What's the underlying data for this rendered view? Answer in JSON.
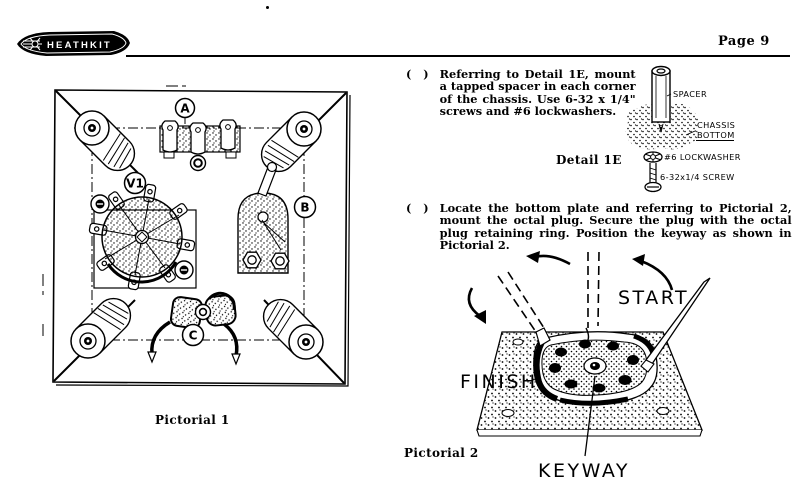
{
  "page": {
    "brand": "HEATHKIT",
    "page_number": "Page 9"
  },
  "instructions": [
    {
      "checkbox": "( )",
      "text": "Referring to Detail 1E, mount a tapped spacer in each corner of the chassis. Use 6-32 x 1/4\" screws and #6 lockwashers."
    },
    {
      "checkbox": "( )",
      "text": "Locate the bottom plate and referring to Pictorial 2, mount the octal plug. Secure the plug with the octal plug retaining ring. Position the keyway as shown in Pictorial 2."
    }
  ],
  "detail_1e": {
    "caption": "Detail 1E",
    "labels": {
      "spacer": "SPACER",
      "chassis_line1": "CHASSIS",
      "chassis_line2": "BOTTOM",
      "lockwasher": "#6 LOCKWASHER",
      "screw": "6-32x1/4 SCREW"
    }
  },
  "pictorial_1": {
    "caption": "Pictorial 1",
    "labels": {
      "a": "A",
      "v1": "V1",
      "b": "B",
      "c": "C"
    }
  },
  "pictorial_2": {
    "caption": "Pictorial 2",
    "labels": {
      "start": "START",
      "finish": "FINISH",
      "keyway": "KEYWAY"
    }
  },
  "colors": {
    "ink": "#000000",
    "paper": "#ffffff"
  }
}
